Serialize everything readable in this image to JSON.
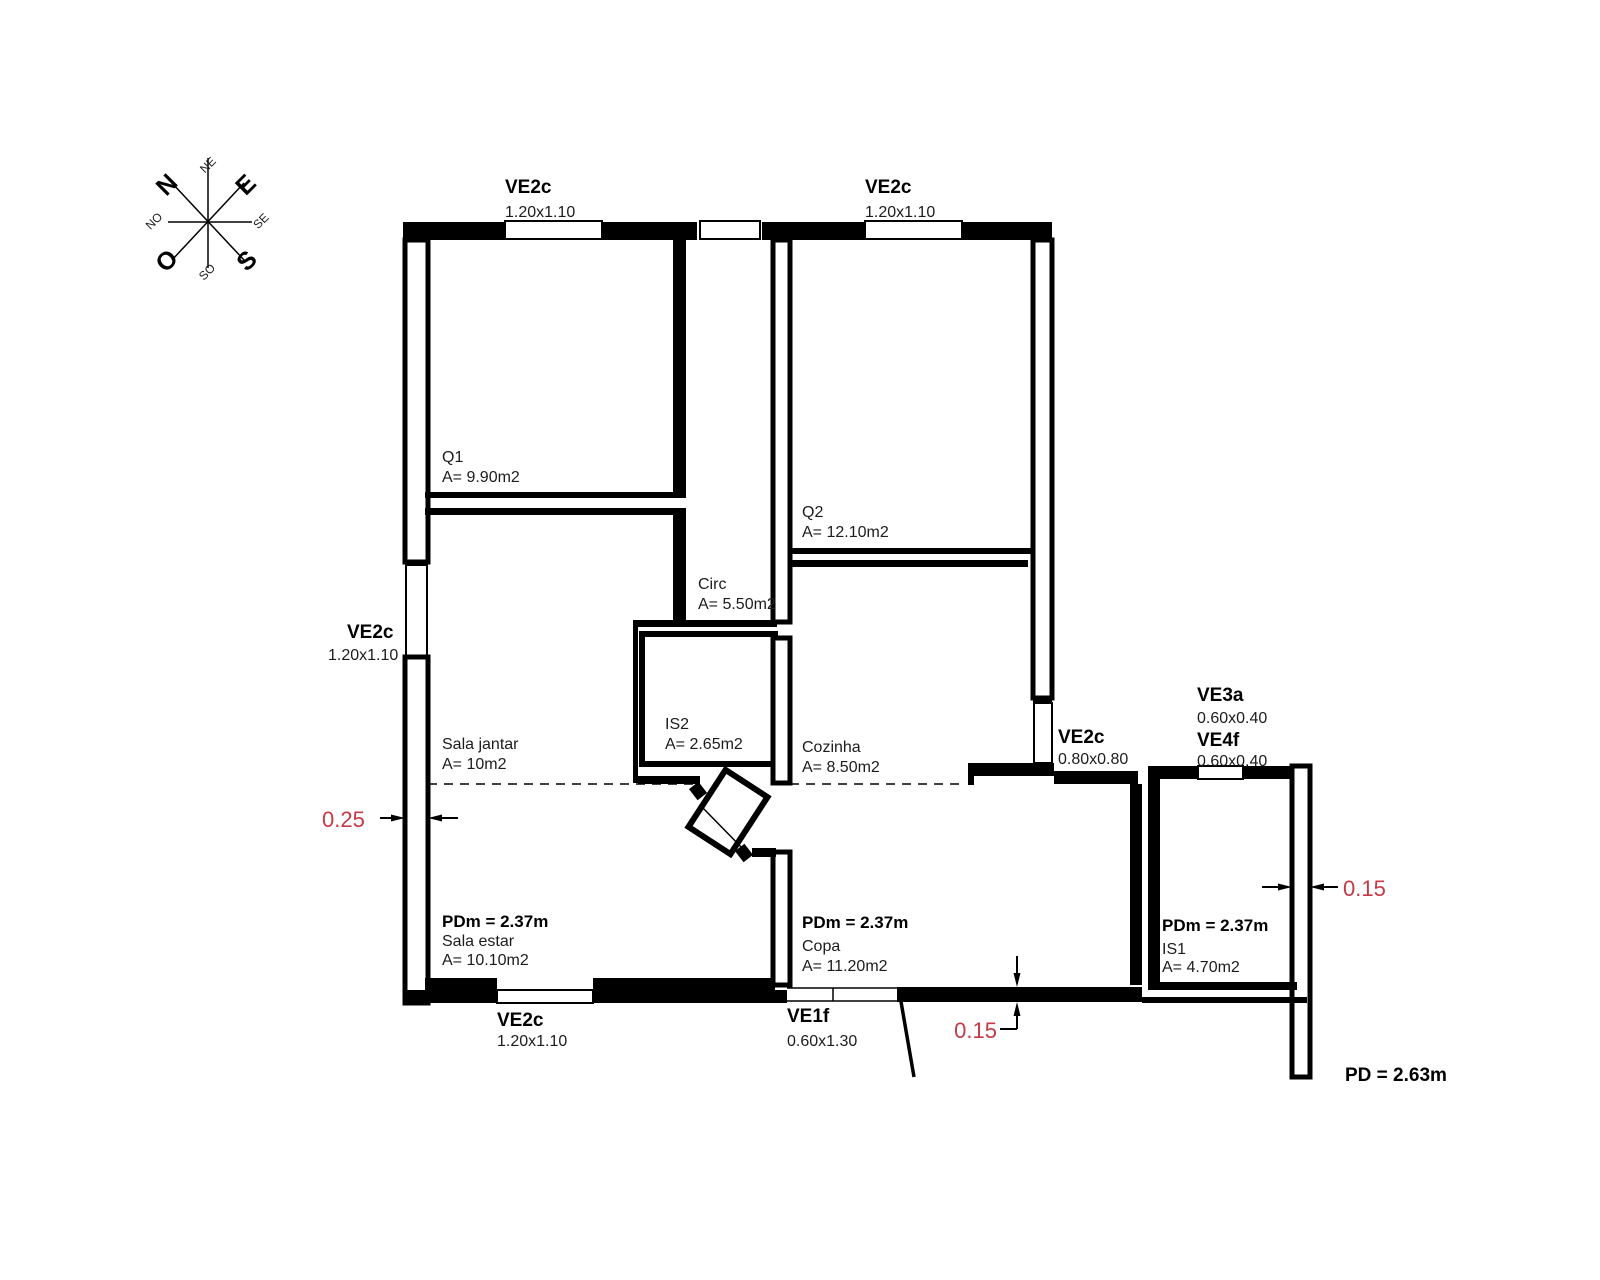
{
  "compass": {
    "n": "N",
    "e": "E",
    "s": "S",
    "o": "O",
    "ne": "NE",
    "se": "SE",
    "so": "SO",
    "no": "NO"
  },
  "openings": {
    "top1": {
      "code": "VE2c",
      "size": "1.20x1.10"
    },
    "top2": {
      "code": "VE2c",
      "size": "1.20x1.10"
    },
    "left": {
      "code": "VE2c",
      "size": "1.20x1.10"
    },
    "bottom": {
      "code": "VE2c",
      "size": "1.20x1.10"
    },
    "door": {
      "code": "VE1f",
      "size": "0.60x1.30"
    },
    "kitchen": {
      "code": "VE2c",
      "size": "0.80x0.80"
    },
    "ve3a": {
      "code": "VE3a",
      "size": "0.60x0.40"
    },
    "ve4f": {
      "code": "VE4f",
      "size": "0.60x0.40"
    }
  },
  "rooms": {
    "q1": {
      "name": "Q1",
      "area": "A= 9.90m2"
    },
    "q2": {
      "name": "Q2",
      "area": "A= 12.10m2"
    },
    "circ": {
      "name": "Circ",
      "area": "A= 5.50m2"
    },
    "is2": {
      "name": "IS2",
      "area": "A= 2.65m2"
    },
    "sala_jantar": {
      "name": "Sala jantar",
      "area": "A= 10m2"
    },
    "cozinha": {
      "name": "Cozinha",
      "area": "A= 8.50m2"
    },
    "sala_estar": {
      "name": "Sala estar",
      "area": "A= 10.10m2",
      "ceiling": "PDm = 2.37m"
    },
    "copa": {
      "name": "Copa",
      "area": "A= 11.20m2",
      "ceiling": "PDm = 2.37m"
    },
    "is1": {
      "name": "IS1",
      "area": "A= 4.70m2",
      "ceiling": "PDm = 2.37m"
    }
  },
  "annotations": {
    "wall_left": "0.25",
    "wall_right": "0.15",
    "wall_bottom": "0.15",
    "ceiling_total": "PD = 2.63m"
  },
  "colors": {
    "line": "#000000",
    "annotation_red": "#c43a46",
    "background": "#ffffff"
  }
}
